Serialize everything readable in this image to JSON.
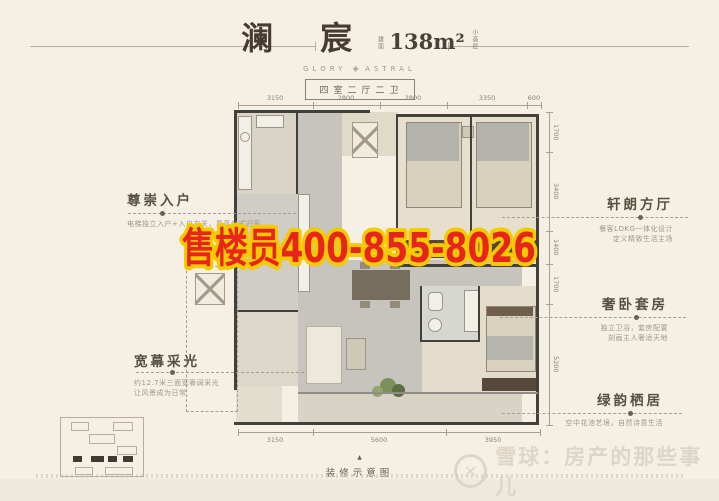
{
  "header": {
    "title": "澜 宸",
    "area_prefix": "建面",
    "area": "138m²",
    "area_suffix": "小高层",
    "subtitle_left": "GLORY",
    "ornament": "◈",
    "subtitle_right": "ASTRAL",
    "badge": "四室二厅二卫"
  },
  "features": {
    "left": [
      {
        "title": "尊崇入户",
        "desc": [
          "电梯独立入户+入户玄关，尊享仪式归家"
        ]
      },
      {
        "title": "宽幕采光",
        "desc": [
          "约12.7米三面宽奢阔采光",
          "让风景成为日常"
        ]
      }
    ],
    "right": [
      {
        "title": "轩朗方厅",
        "desc": [
          "餐客LDKG一体化设计",
          "定义精致生活主场"
        ]
      },
      {
        "title": "奢卧套房",
        "desc": [
          "独立卫浴，套房配置",
          "刻画主人奢适天地"
        ]
      },
      {
        "title": "绿韵栖居",
        "desc": [
          "空中花池艺境，自然诗意生活"
        ]
      }
    ]
  },
  "dimensions": {
    "top": [
      "3150",
      "2800",
      "2800",
      "3350",
      "600"
    ],
    "bottom": [
      "3150",
      "5600",
      "3950"
    ],
    "right": [
      "1700",
      "3400",
      "1400",
      "1700",
      "5200"
    ]
  },
  "overlay": {
    "phone": "售楼员400-855-8026"
  },
  "plan": {
    "caption": "装修示意图",
    "marker": "▲"
  },
  "watermark": {
    "logo": "✕",
    "text": "雪球：房产的那些事儿"
  },
  "colors": {
    "accent_red": "#e8251c",
    "accent_yellow": "#f5cb00",
    "wall": "#41403a",
    "background": "#f6f0e4"
  }
}
